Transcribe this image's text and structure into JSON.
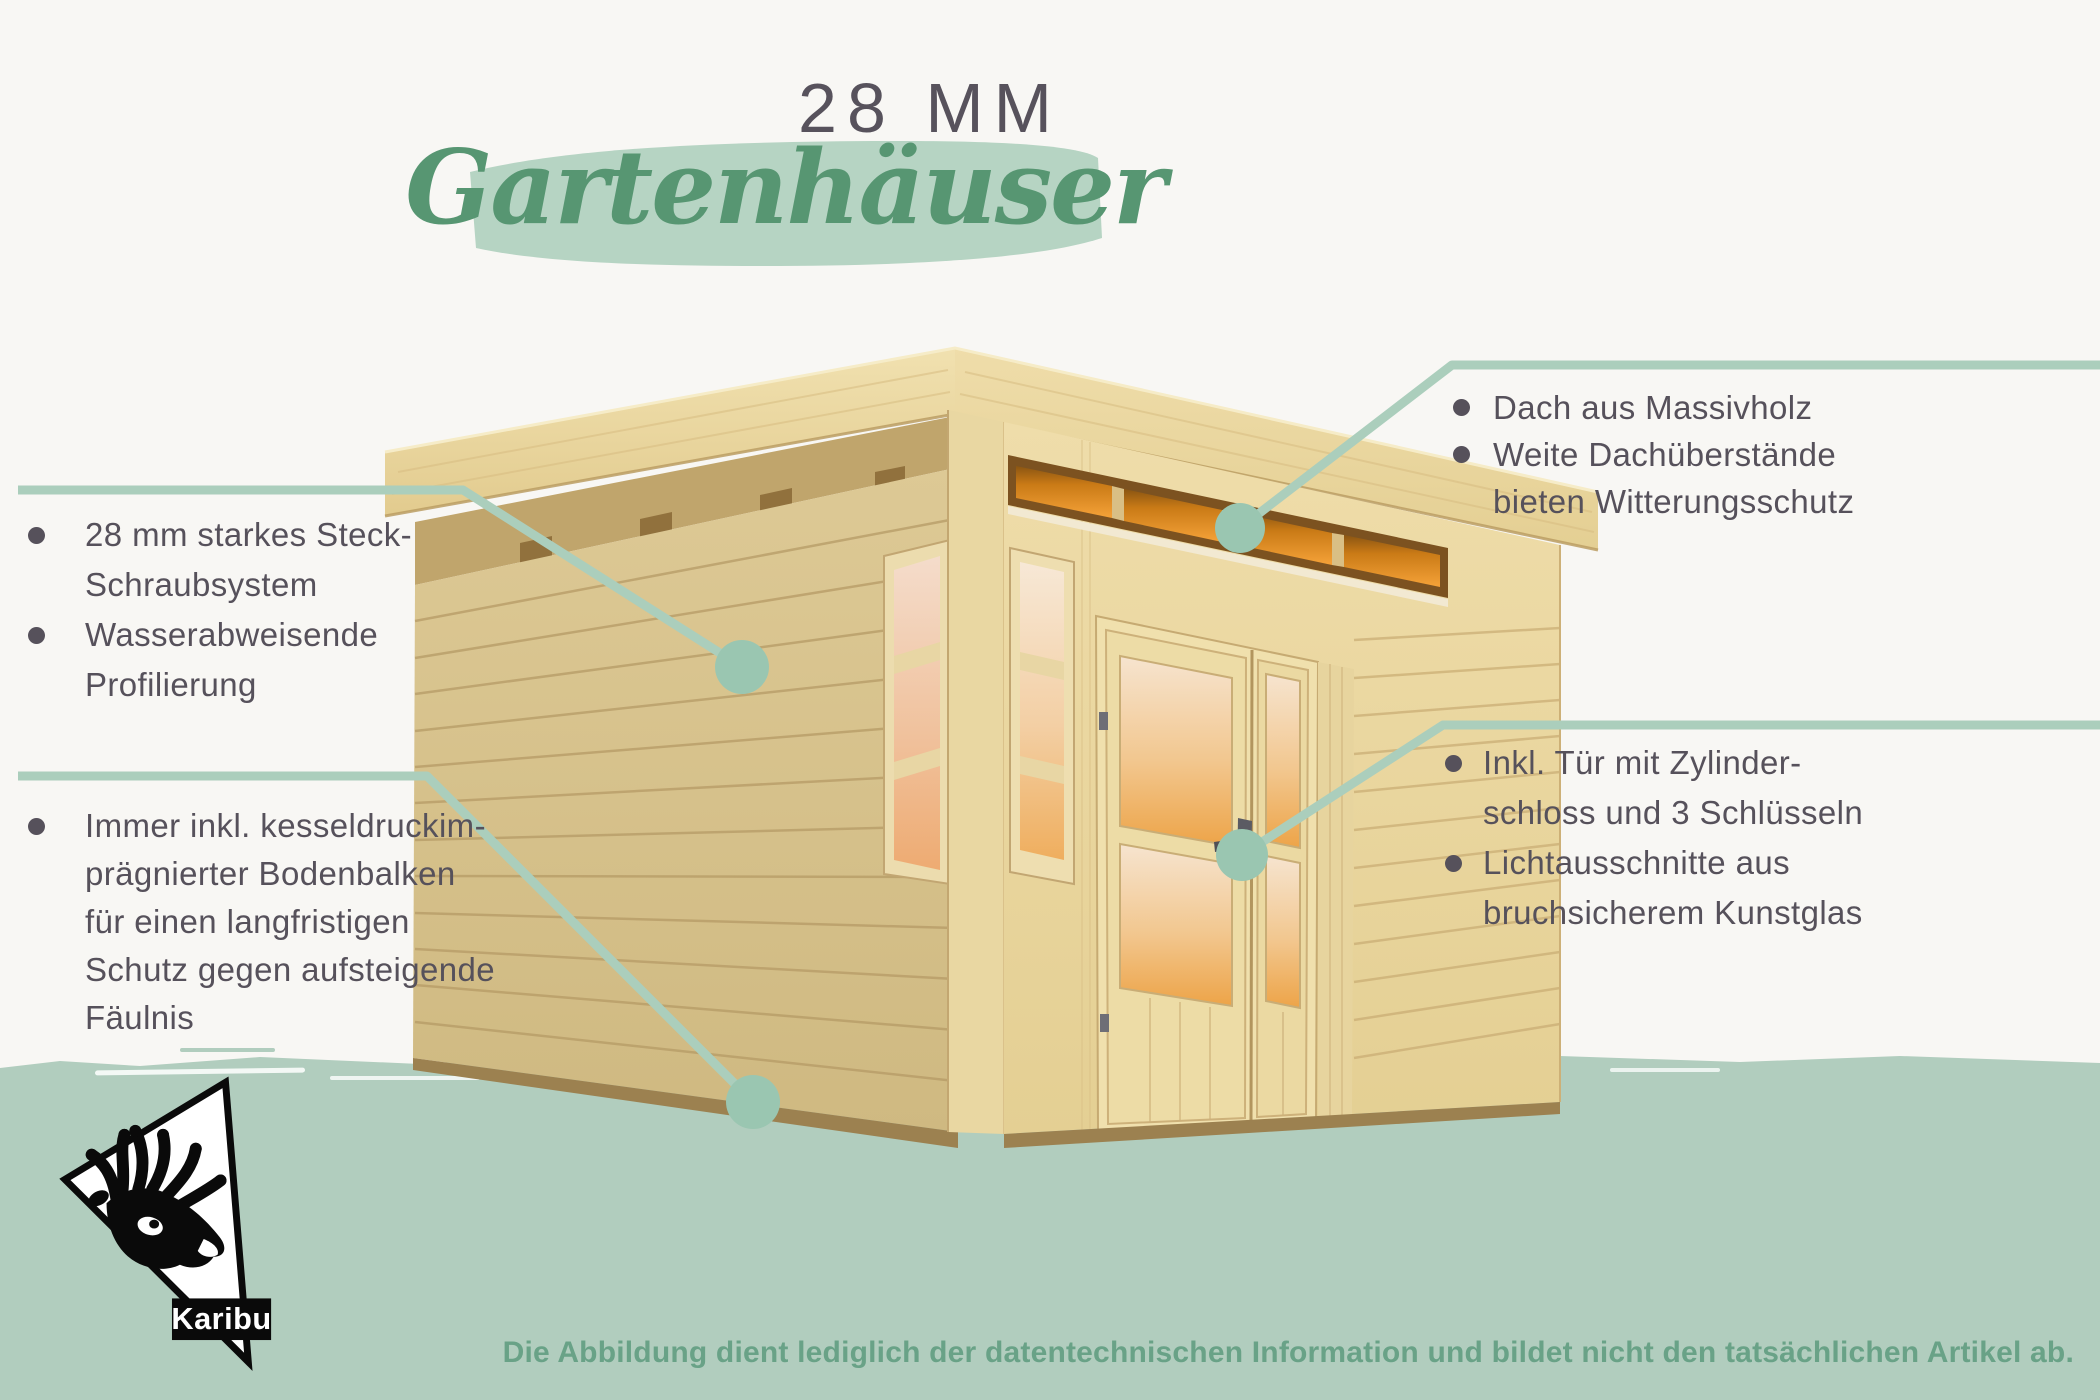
{
  "title": {
    "size_label": "28 MM",
    "product_label": "Gartenhäuser"
  },
  "callouts": {
    "left_top": {
      "target": "side-wall-planks",
      "lines": [
        {
          "bullet": true,
          "text": "28 mm starkes Steck-"
        },
        {
          "bullet": false,
          "text": "Schraubsystem"
        },
        {
          "bullet": true,
          "text": "Wasserabweisende"
        },
        {
          "bullet": false,
          "text": "Profilierung"
        }
      ]
    },
    "left_bottom": {
      "target": "floor-beam-base",
      "lines": [
        {
          "bullet": true,
          "text": "Immer inkl. kesseldruckim-"
        },
        {
          "bullet": false,
          "text": "prägnierter Bodenbalken"
        },
        {
          "bullet": false,
          "text": "für einen langfristigen"
        },
        {
          "bullet": false,
          "text": "Schutz gegen aufsteigende"
        },
        {
          "bullet": false,
          "text": "Fäulnis"
        }
      ]
    },
    "right_top": {
      "target": "roof",
      "lines": [
        {
          "bullet": true,
          "text": "Dach aus Massivholz"
        },
        {
          "bullet": true,
          "text": "Weite Dachüberstände"
        },
        {
          "bullet": false,
          "text": "bieten Witterungsschutz"
        }
      ]
    },
    "right_bottom": {
      "target": "door-handle",
      "lines": [
        {
          "bullet": true,
          "text": "Inkl. Tür mit Zylinder-"
        },
        {
          "bullet": false,
          "text": "schloss und 3 Schlüsseln"
        },
        {
          "bullet": true,
          "text": "Lichtausschnitte aus"
        },
        {
          "bullet": false,
          "text": "bruchsicherem Kunstglas"
        }
      ]
    }
  },
  "brand": {
    "logo_text": "Karibu",
    "logo_icon": "reindeer-head-icon"
  },
  "footer": {
    "disclaimer": "Die Abbildung dient lediglich der datentechnischen Information und bildet nicht den tatsächlichen Artikel ab."
  },
  "colors": {
    "background": "#f8f7f4",
    "band_green": "#b1cdbe",
    "callout_line": "#abcebc",
    "callout_dot": "#9ac6b1",
    "script_green": "#579672",
    "swash_green": "#b6d4c3",
    "text_dark": "#56515b",
    "disclaimer_green": "#69a287",
    "wood_light": "#ecd9a4",
    "wood_shadow": "#d6c28f",
    "window_glow_orange": "#ef9b2d"
  },
  "illustration": {
    "subject": "wooden flat-roof garden house with double glass door, corner windows and clerestory window strip"
  }
}
